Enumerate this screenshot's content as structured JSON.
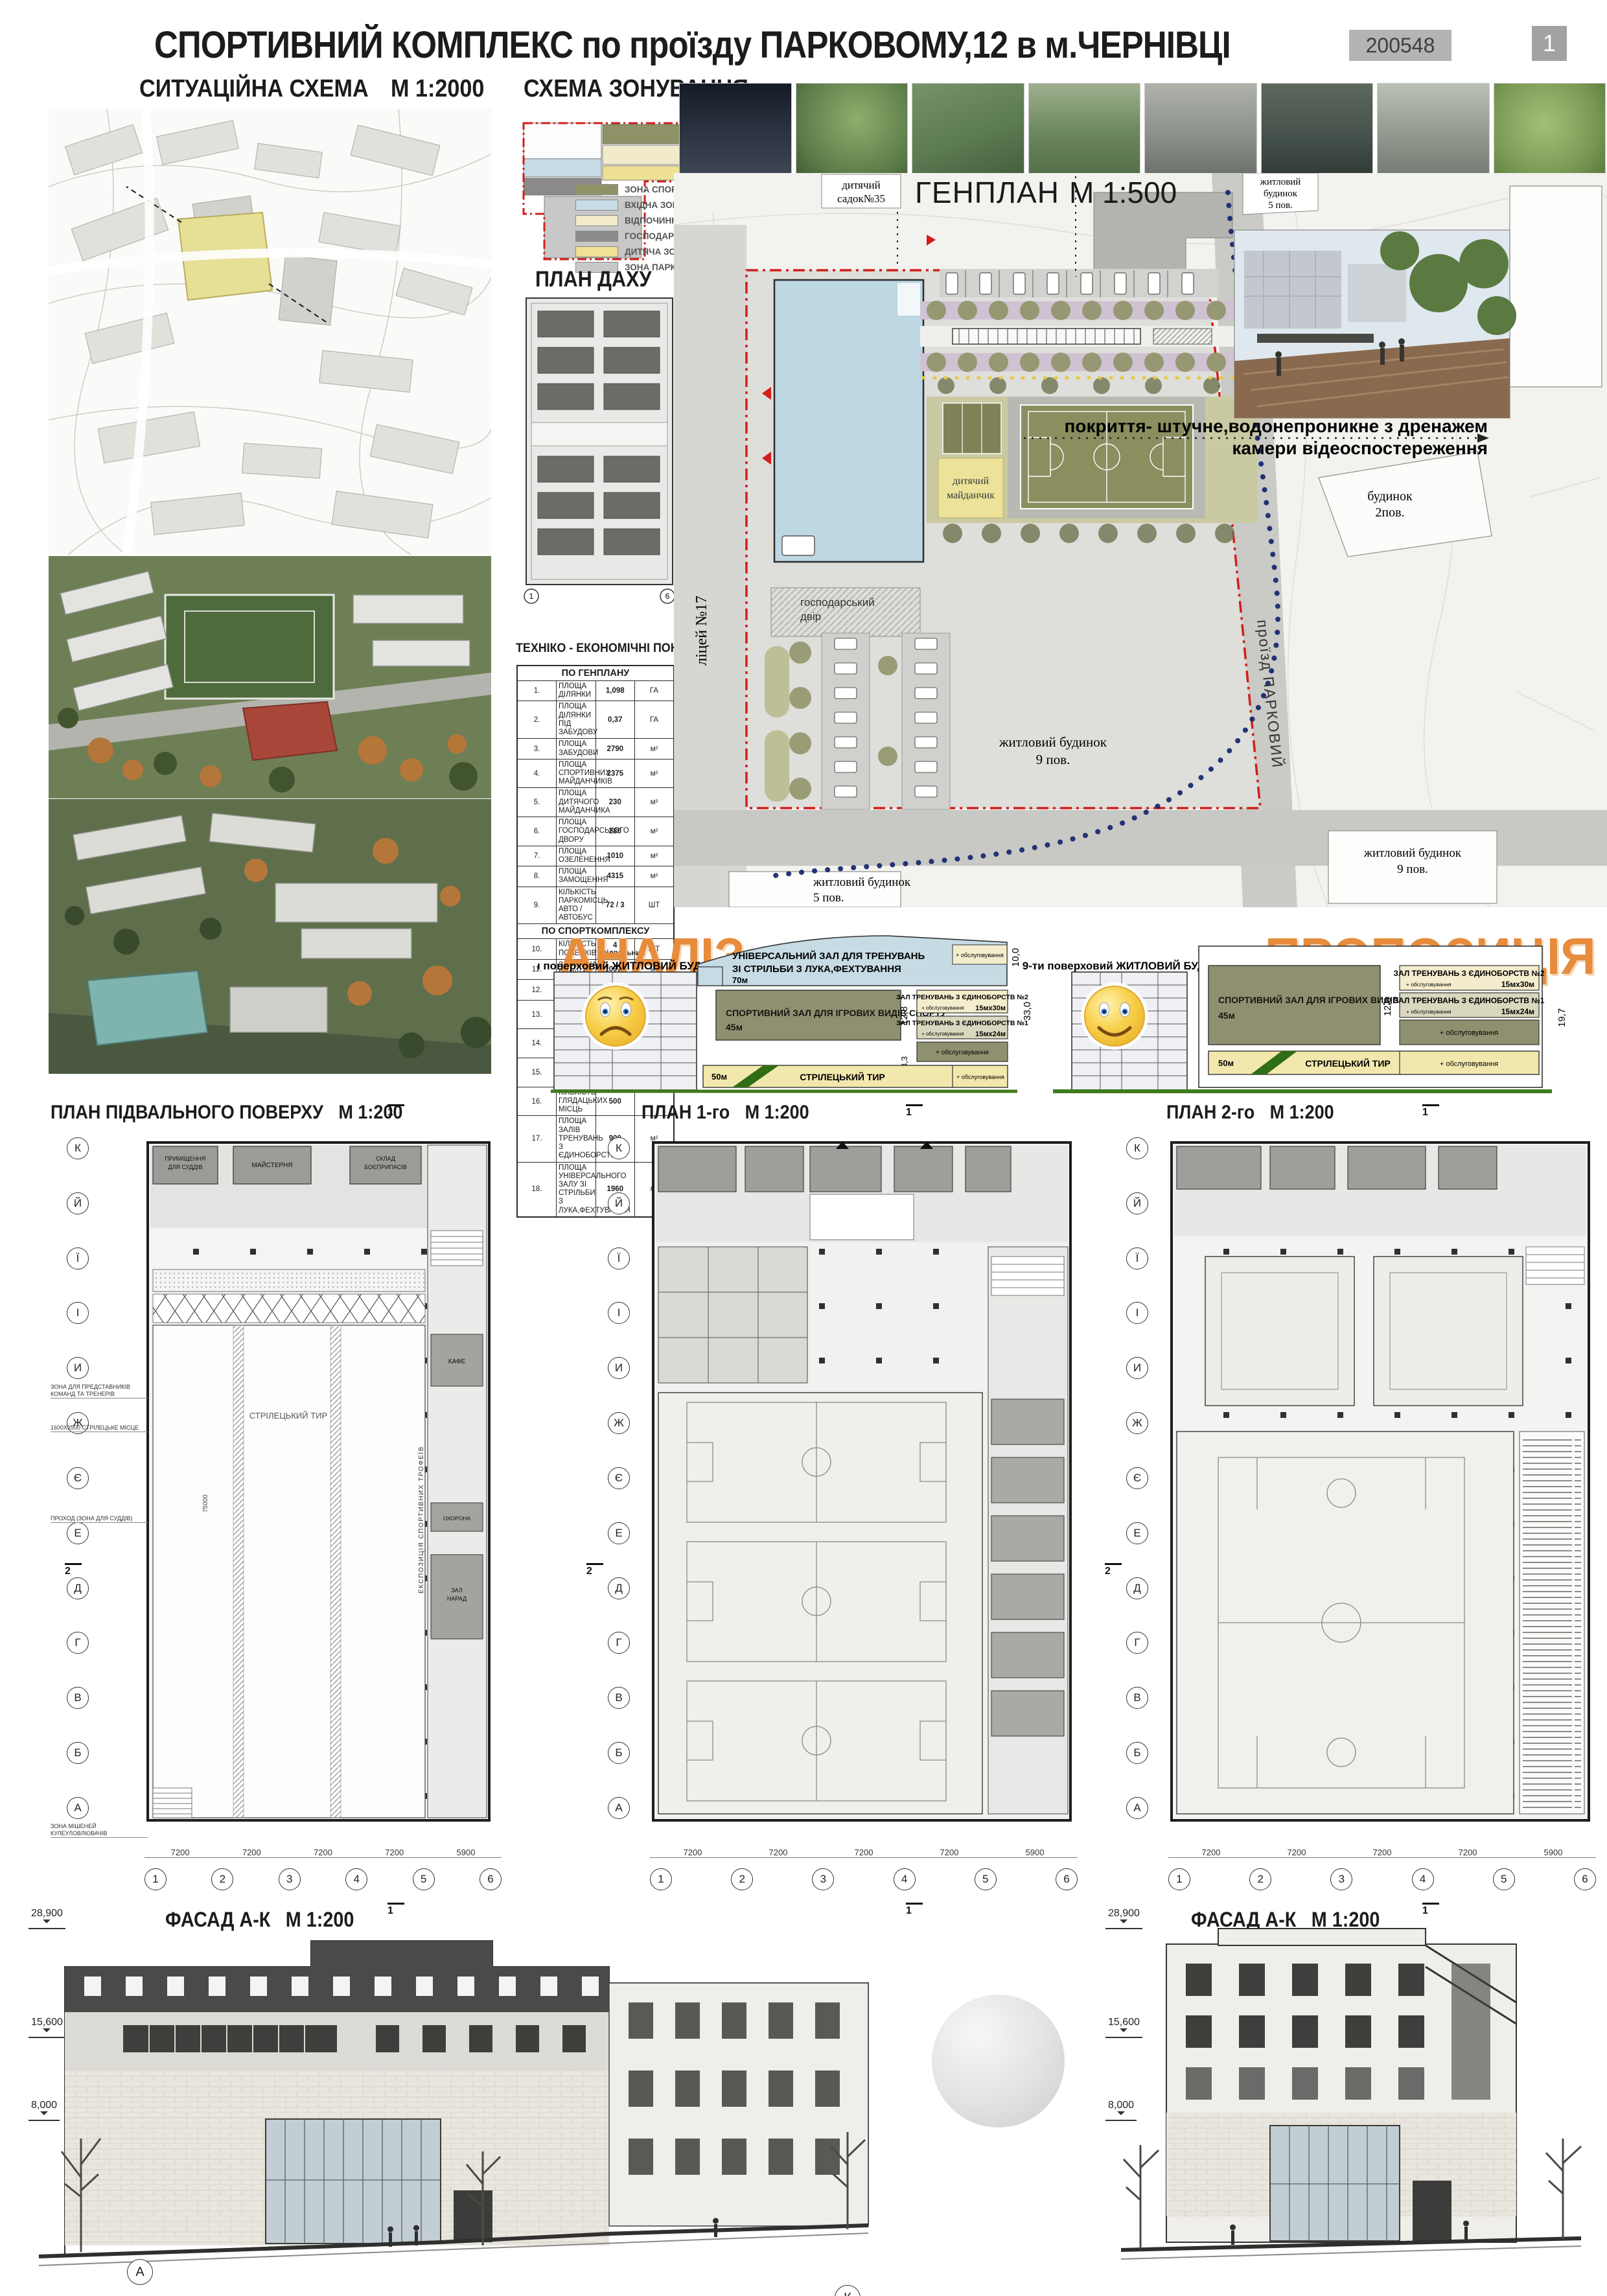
{
  "header": {
    "title": "СПОРТИВНИЙ КОМПЛЕКС по проїзду ПАРКОВОМУ,12  в  м.ЧЕРНІВЦІ",
    "code": "200548",
    "sheet": "1"
  },
  "situation": {
    "title": "СИТУАЦІЙНА СХЕМА",
    "scale": "М 1:2000"
  },
  "zoning": {
    "title": "СХЕМА ЗОНУВАННЯ",
    "legend": [
      {
        "label": "ЗОНА СПОРТИВНИХ МАЙДАНЧИКІВ",
        "color": "#8f9266"
      },
      {
        "label": "ВХІДНА ЗОНА",
        "color": "#c8dce8"
      },
      {
        "label": "ВІДПОЧИНКОВА ЗОНА",
        "color": "#f1ebcb"
      },
      {
        "label": "ГОСПОДАРСЬКИЙ ДВІР",
        "color": "#8a8a8a"
      },
      {
        "label": "ДИТЯЧА ЗОНА",
        "color": "#efe193"
      },
      {
        "label": "ЗОНА  ПАРКОВОК",
        "color": "#c8c8c8"
      }
    ]
  },
  "roof": {
    "title": "ПЛАН ДАХУ",
    "scale": "М 1:500",
    "axis": [
      "1",
      "6"
    ]
  },
  "tep": {
    "title": "ТЕХНІКО - ЕКОНОМІЧНІ ПОКАЗНИКИ",
    "section1": "ПО ГЕНПЛАНУ",
    "section2": "ПО СПОРТКОМПЛЕКСУ",
    "genplan_rows": [
      {
        "n": "1.",
        "label": "ПЛОЩА ДІЛЯНКИ",
        "value": "1,098",
        "unit": "ГА"
      },
      {
        "n": "2.",
        "label": "ПЛОЩА ДІЛЯНКИ ПІД ЗАБУДОВУ",
        "value": "0,37",
        "unit": "ГА"
      },
      {
        "n": "3.",
        "label": "ПЛОЩА ЗАБУДОВИ",
        "value": "2790",
        "unit": "м²"
      },
      {
        "n": "4.",
        "label": "ПЛОЩА СПОРТИВНИХ МАЙДАНЧИКІВ",
        "value": "2375",
        "unit": "м²"
      },
      {
        "n": "5.",
        "label": "ПЛОЩА ДИТЯЧОГО МАЙДАНЧИКА",
        "value": "230",
        "unit": "м²"
      },
      {
        "n": "6.",
        "label": "ПЛОЩА ГОСПОДАРСЬКОГО ДВОРУ",
        "value": "280",
        "unit": "м²"
      },
      {
        "n": "7.",
        "label": "ПЛОЩА ОЗЕЛЕНЕННЯ",
        "value": "1010",
        "unit": "м²"
      },
      {
        "n": "8.",
        "label": "ПЛОЩА ЗАМОЩЕННЯ",
        "value": "4315",
        "unit": "м²"
      },
      {
        "n": "9.",
        "label": "КІЛЬКІСТЬ ПАРКОМІСЦЬ АВТО / АВТОБУС",
        "value": "72 / 3",
        "unit": "ШТ"
      }
    ],
    "complex_rows": [
      {
        "n": "10.",
        "label": "КІЛЬКІСТЬ ПОВЕРХІВ",
        "value": "4 +підвальний",
        "unit": "ШТ"
      },
      {
        "n": "11.",
        "label": "ЗАГАЛЬНА ПЛОЩА",
        "value": "10975",
        "unit": "м²"
      },
      {
        "n": "12.",
        "label": "БУДІВЕЛЬНИЙ ОБ'ЄМ",
        "value": "79350",
        "unit": "м³"
      },
      {
        "n": "13.",
        "label": "ПЛОЩА ЗАЛУ (ТИР)",
        "value": "1350",
        "unit": "м²"
      },
      {
        "n": "14.",
        "label": "КІЛЬКІСТЬ СТРІЛЕЦЬКИХ МІСЦЬ",
        "value": "10",
        "unit": "ШТ"
      },
      {
        "n": "15.",
        "label": "ПЛОЩА ІГРОВОГО ЗАЛУ",
        "value": "1200",
        "unit": "м²"
      },
      {
        "n": "16.",
        "label": "КІЛЬКІСТЬ ГЛЯДАЦЬКИХ МІСЦЬ",
        "value": "500",
        "unit": ""
      },
      {
        "n": "17.",
        "label": "ПЛОЩА ЗАЛІВ ТРЕНУВАНЬ З ЄДИНОБОРСТВ",
        "value": "900",
        "unit": "м²"
      },
      {
        "n": "18.",
        "label": "ПЛОЩА УНІВЕРСАЛЬНОГО ЗАЛУ ЗІ СТРІЛЬБИ З ЛУКА,ФЕХТУВАННЯ",
        "value": "1960",
        "unit": "м²"
      }
    ]
  },
  "photos": {
    "items": [
      {
        "name": "photo-night-park-lighting"
      },
      {
        "name": "photo-playground"
      },
      {
        "name": "photo-outdoor-fitness"
      },
      {
        "name": "photo-sports-court-park"
      },
      {
        "name": "photo-bike-lane"
      },
      {
        "name": "photo-bike-pavilion"
      },
      {
        "name": "photo-rollerblading-people"
      },
      {
        "name": "photo-kids-scooters"
      }
    ]
  },
  "genplan": {
    "title": "ГЕНПЛАН",
    "scale": "М 1:500",
    "note1": "покриття- штучне,водонепроникне з дренажем",
    "note2": "камери відеоспостереження",
    "labels": {
      "kindergarten": [
        "дитячий",
        "садок№35"
      ],
      "house5": [
        "житловий",
        "будинок",
        "5 пов."
      ],
      "house9": [
        "житловий будинок",
        "9 пов."
      ],
      "house9b": [
        "житловий будинок",
        "9 пов."
      ],
      "house2": [
        "будинок",
        "2пов."
      ],
      "house5b": [
        "житловий будинок",
        "5 пов."
      ],
      "lyceum": "ліцей №17",
      "utility": [
        "господарський",
        "двір"
      ],
      "kids": [
        "дитячий",
        "майданчик"
      ],
      "street": "проїзд ПАРКОВИЙ"
    }
  },
  "analysis": {
    "title": "АНАЛІЗ",
    "proposal_title": "ПРОПОЗИЦІЯ",
    "residential": "9-ти поверховий ЖИТЛОВИЙ БУДИНОК",
    "universal_hall": [
      "УНІВЕРСАЛЬНИЙ ЗАЛ ДЛЯ ТРЕНУВАНЬ",
      "ЗІ  СТРІЛЬБИ З ЛУКА,ФЕХТУВАННЯ",
      "70м"
    ],
    "sport_hall": [
      "СПОРТИВНИЙ ЗАЛ ДЛЯ ІГРОВИХ ВИДІВ СПОРТУ",
      "45м"
    ],
    "hall2": "ЗАЛ ТРЕНУВАНЬ З ЄДИНОБОРСТВ  №2",
    "hall2_size": "15мх30м",
    "hall1": "ЗАЛ ТРЕНУВАНЬ З ЄДИНОБОРСТВ  №1",
    "hall1_size": "15мх24м",
    "service": "+ обслуговування",
    "tir": "СТРІЛЕЦЬКИЙ ТИР",
    "tir_len": "50м",
    "dim_10": "10,0",
    "dim_33": "33,0",
    "dim_128": "12,8",
    "dim_33b": "3,3",
    "dim_197": "19,7"
  },
  "plans": {
    "basement_title": "ПЛАН  ПІДВАЛЬНОГО ПОВЕРХУ",
    "first_title": "ПЛАН 1-го",
    "second_title": "ПЛАН 2-го",
    "scale": "М 1:200",
    "axis_letters": [
      "К",
      "Й",
      "Ї",
      "І",
      "И",
      "Ж",
      "Є",
      "Е",
      "Д",
      "Г",
      "В",
      "Б",
      "А"
    ],
    "axis_numbers": [
      "1",
      "2",
      "3",
      "4",
      "5",
      "6"
    ],
    "dims": [
      "7200",
      "7200",
      "7200",
      "7200",
      "5900"
    ],
    "dim_total": "75000",
    "section_mark_1": "1",
    "section_mark_2": "2",
    "rooms": {
      "judges": [
        "ПРИМІЩЕННЯ",
        "ДЛЯ СУДДІВ"
      ],
      "workshop": "МАЙСТЕРНЯ",
      "ammo": [
        "СКЛАД",
        "БОЄПРИПАСІВ"
      ],
      "tir": "СТРІЛЕЦЬКИЙ ТИР",
      "cafe": "КАФЕ",
      "meeting": [
        "ЗАЛ",
        "НАРАД"
      ],
      "security": "ОХОРОНА",
      "exhibition": "ЕКСПОЗИЦІЯ СПОРТИВНИХ ТРОФЕЇВ"
    },
    "annotations": [
      "ЗОНА ДЛЯ ПРЕДСТАВНИКІВ КОМАНД ТА ТРЕНЕРІВ",
      "1600Х2500 СТРІЛЕЦЬКЕ МІСЦЕ",
      "ПРОХОД (ЗОНА ДЛЯ СУДДІВ)",
      "ЗОНА МІШЕНЕЙ КУЛЕУЛОВЛЮВАЧІВ"
    ]
  },
  "facades": {
    "title": "ФАСАД  А-К",
    "scale": "М 1:200",
    "elevations": [
      "28,900",
      "15,600",
      "8,000"
    ],
    "left_letters": [
      "А",
      "К"
    ],
    "right_letters": [
      "К",
      "А"
    ]
  }
}
